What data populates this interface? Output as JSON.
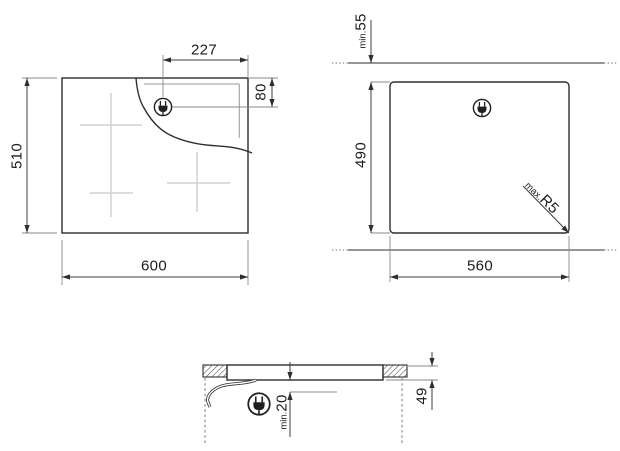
{
  "colors": {
    "background": "#ffffff",
    "line": "#2e2e2e",
    "dimension_line": "#3c3c3c",
    "extension_line": "#8a8a8a",
    "zone_cross": "#d2d2d2",
    "text": "#1c1c1c"
  },
  "icons": {
    "plug": "power-plug-icon"
  },
  "top_view": {
    "dim_width": "600",
    "dim_depth": "510",
    "dim_plug_from_right": "227",
    "dim_plug_from_top": "80"
  },
  "cutout_view": {
    "dim_width": "560",
    "dim_depth": "490",
    "wall_clearance_prefix": "min.",
    "wall_clearance_value": "55",
    "corner_radius_prefix": "max.",
    "corner_radius_value": "R5"
  },
  "side_view": {
    "clearance_below_prefix": "min.",
    "clearance_below_value": "20",
    "dim_height": "49"
  }
}
